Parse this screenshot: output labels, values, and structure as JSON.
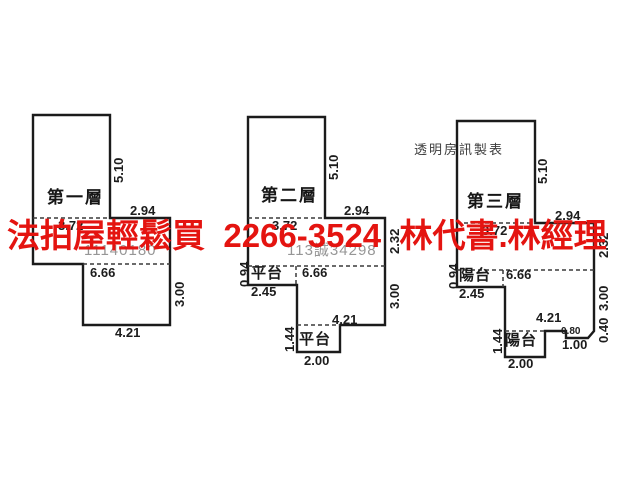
{
  "canvas": {
    "width": 640,
    "height": 480,
    "background": "#ffffff",
    "line_color": "#1b1b1b",
    "dash_color": "#3a3a3a"
  },
  "overlay": {
    "text": "法拍屋輕鬆買  2266-3524  林代書.林經理",
    "color": "#e41410"
  },
  "plans": [
    {
      "title": "第一層",
      "case_watermark": "11140180",
      "outline": [
        [
          33,
          115
        ],
        [
          110,
          115
        ],
        [
          110,
          218
        ],
        [
          170,
          218
        ],
        [
          170,
          325
        ],
        [
          83,
          325
        ],
        [
          83,
          264
        ],
        [
          33,
          264
        ]
      ],
      "dashes": [
        [
          33,
          218,
          110,
          218
        ],
        [
          83,
          264,
          170,
          264
        ]
      ],
      "labels": [
        {
          "t": "第一層",
          "x": 47,
          "y": 189,
          "cls": "floor"
        },
        {
          "t": "5.10",
          "x": 112,
          "y": 183,
          "cls": "dimv"
        },
        {
          "t": "2.94",
          "x": 130,
          "y": 204,
          "cls": "dim"
        },
        {
          "t": "3.72",
          "x": 58,
          "y": 219,
          "cls": "dim"
        },
        {
          "t": "11140180",
          "x": 84,
          "y": 243,
          "cls": "wm"
        },
        {
          "t": "6.66",
          "x": 90,
          "y": 266,
          "cls": "dim"
        },
        {
          "t": "3.00",
          "x": 173,
          "y": 307,
          "cls": "dimv"
        },
        {
          "t": "4.21",
          "x": 115,
          "y": 326,
          "cls": "dim"
        }
      ]
    },
    {
      "title": "第二層",
      "case_watermark": "113誠34298",
      "outline": [
        [
          248,
          117
        ],
        [
          325,
          117
        ],
        [
          325,
          218
        ],
        [
          385,
          218
        ],
        [
          385,
          325
        ],
        [
          340,
          325
        ],
        [
          340,
          352
        ],
        [
          297,
          352
        ],
        [
          297,
          285
        ],
        [
          248,
          285
        ]
      ],
      "dashes": [
        [
          248,
          218,
          325,
          218
        ],
        [
          248,
          266,
          385,
          266
        ],
        [
          297,
          325,
          340,
          325
        ],
        [
          296,
          266,
          296,
          285
        ]
      ],
      "labels": [
        {
          "t": "第二層",
          "x": 261,
          "y": 187,
          "cls": "floor"
        },
        {
          "t": "5.10",
          "x": 327,
          "y": 180,
          "cls": "dimv"
        },
        {
          "t": "2.94",
          "x": 344,
          "y": 204,
          "cls": "dim"
        },
        {
          "t": "3.72",
          "x": 272,
          "y": 219,
          "cls": "dim"
        },
        {
          "t": "113誠34298",
          "x": 287,
          "y": 243,
          "cls": "wm"
        },
        {
          "t": "2.32",
          "x": 388,
          "y": 254,
          "cls": "dimv"
        },
        {
          "t": "0.94",
          "x": 238,
          "y": 287,
          "cls": "dimv"
        },
        {
          "t": "平台",
          "x": 251,
          "y": 266,
          "cls": "room"
        },
        {
          "t": "6.66",
          "x": 302,
          "y": 266,
          "cls": "dim"
        },
        {
          "t": "2.45",
          "x": 251,
          "y": 285,
          "cls": "dim"
        },
        {
          "t": "3.00",
          "x": 388,
          "y": 309,
          "cls": "dimv"
        },
        {
          "t": "4.21",
          "x": 332,
          "y": 313,
          "cls": "dim"
        },
        {
          "t": "1.44",
          "x": 283,
          "y": 352,
          "cls": "dimv"
        },
        {
          "t": "平台",
          "x": 299,
          "y": 332,
          "cls": "room"
        },
        {
          "t": "2.00",
          "x": 304,
          "y": 354,
          "cls": "dim"
        }
      ]
    },
    {
      "title": "第三層",
      "outline": [
        [
          457,
          121
        ],
        [
          535,
          121
        ],
        [
          535,
          223
        ],
        [
          594,
          223
        ],
        [
          594,
          331
        ],
        [
          588,
          338
        ],
        [
          566,
          338
        ],
        [
          566,
          331
        ],
        [
          545,
          331
        ],
        [
          545,
          357
        ],
        [
          505,
          357
        ],
        [
          505,
          287
        ],
        [
          457,
          287
        ]
      ],
      "dashes": [
        [
          457,
          223,
          535,
          223
        ],
        [
          457,
          270,
          594,
          270
        ],
        [
          505,
          331,
          545,
          331
        ],
        [
          503,
          270,
          503,
          287
        ]
      ],
      "labels": [
        {
          "t": "透明房訊製表",
          "x": 414,
          "y": 143,
          "cls": "note"
        },
        {
          "t": "第三層",
          "x": 467,
          "y": 193,
          "cls": "floor"
        },
        {
          "t": "5.10",
          "x": 536,
          "y": 184,
          "cls": "dimv"
        },
        {
          "t": "2.94",
          "x": 555,
          "y": 209,
          "cls": "dim"
        },
        {
          "t": "3.72",
          "x": 482,
          "y": 224,
          "cls": "dim"
        },
        {
          "t": "2.32",
          "x": 597,
          "y": 258,
          "cls": "dimv"
        },
        {
          "t": "0.94",
          "x": 447,
          "y": 289,
          "cls": "dimv"
        },
        {
          "t": "陽台",
          "x": 459,
          "y": 268,
          "cls": "room"
        },
        {
          "t": "6.66",
          "x": 506,
          "y": 268,
          "cls": "dim"
        },
        {
          "t": "2.45",
          "x": 459,
          "y": 287,
          "cls": "dim"
        },
        {
          "t": "3.00",
          "x": 597,
          "y": 311,
          "cls": "dimv"
        },
        {
          "t": "0.40",
          "x": 597,
          "y": 343,
          "cls": "dimv"
        },
        {
          "t": "4.21",
          "x": 536,
          "y": 311,
          "cls": "dim"
        },
        {
          "t": "0.80",
          "x": 561,
          "y": 327,
          "cls": "dimsmall"
        },
        {
          "t": "1.00",
          "x": 562,
          "y": 338,
          "cls": "dim"
        },
        {
          "t": "1.44",
          "x": 491,
          "y": 354,
          "cls": "dimv"
        },
        {
          "t": "陽台",
          "x": 505,
          "y": 333,
          "cls": "room"
        },
        {
          "t": "2.00",
          "x": 508,
          "y": 357,
          "cls": "dim"
        }
      ]
    }
  ]
}
